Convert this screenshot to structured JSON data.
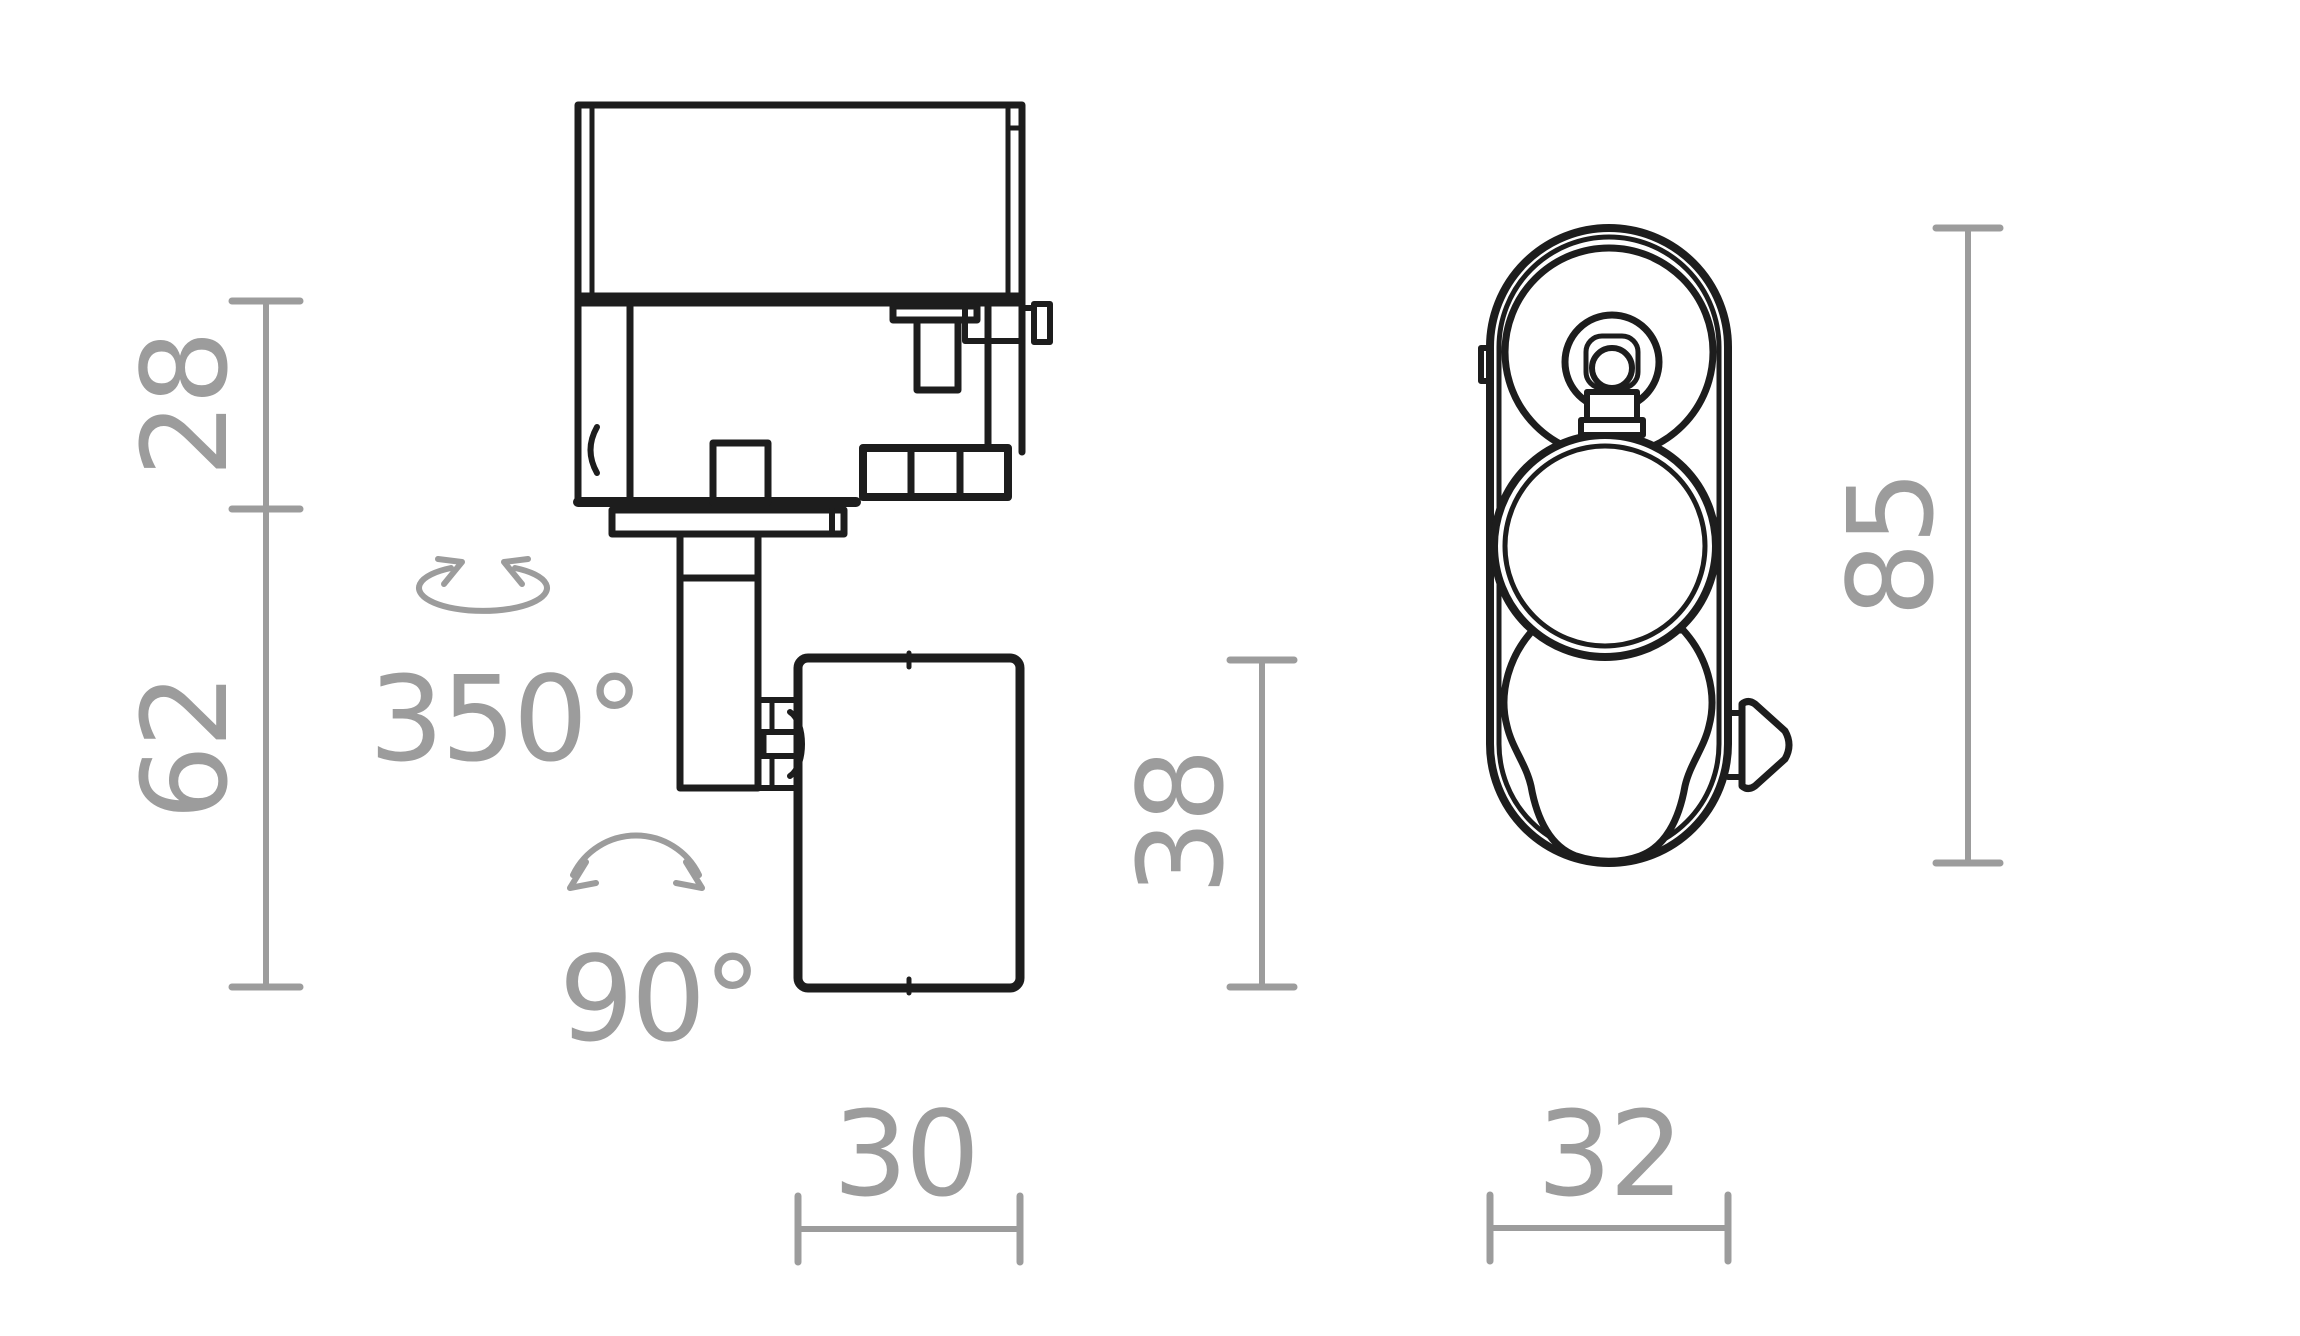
{
  "drawing_type": "technical dimension drawing",
  "colors": {
    "outline": "#1d1d1d",
    "dimension": "#9c9c9c",
    "background": "#ffffff"
  },
  "side_view": {
    "name": "side view of track spotlight",
    "dims": {
      "adapter_height": "28",
      "body_height": "62",
      "head_height": "38",
      "head_width": "30"
    },
    "annotations": {
      "rotation": "350°",
      "tilt": "90°"
    },
    "icons": {
      "rotation_arrow": "ellipse-rotation-arrow",
      "tilt_arrow": "arc-tilt-arrow"
    }
  },
  "front_view": {
    "name": "front view of track spotlight",
    "dims": {
      "total_height": "85",
      "total_width": "32"
    }
  }
}
